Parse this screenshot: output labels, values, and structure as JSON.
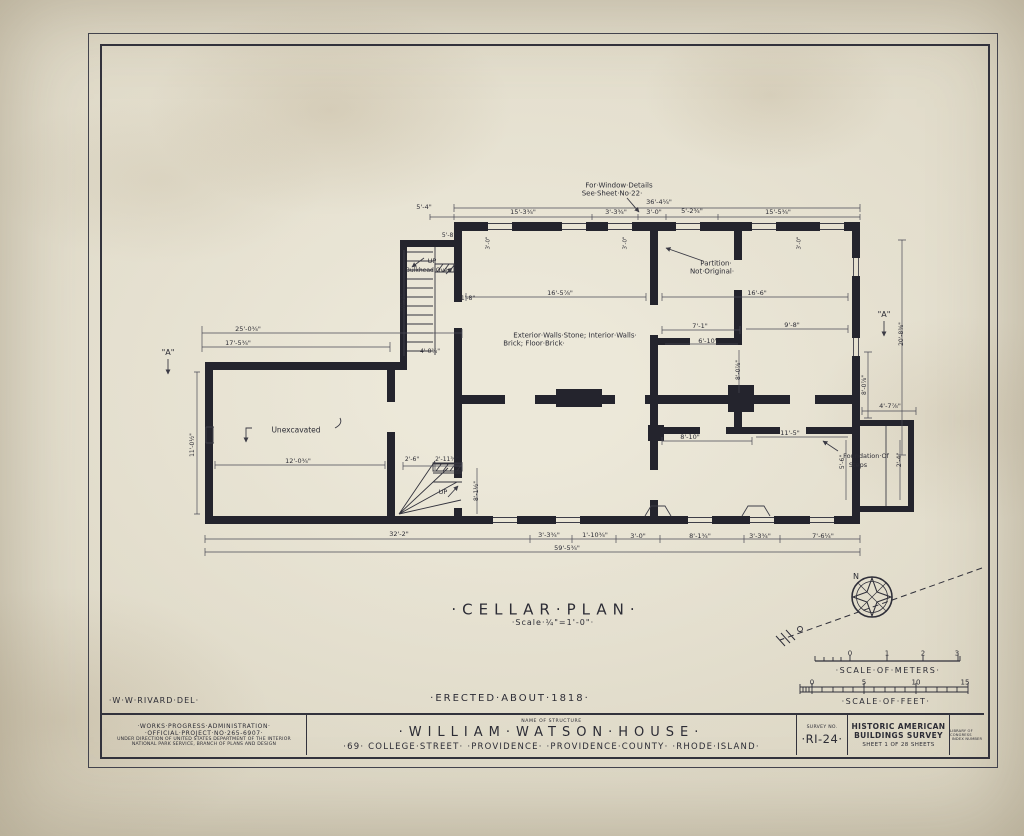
{
  "colors": {
    "ink": "#2c2c35",
    "wall_ink": "#24242d",
    "paper": "#ded8c6"
  },
  "title_block": {
    "wpa_line1": "·WORKS·PROGRESS·ADMINISTRATION·",
    "wpa_line2": "·OFFICIAL·PROJECT·NO·265-6907·",
    "wpa_line3": "UNDER DIRECTION OF UNITED STATES DEPARTMENT OF THE INTERIOR",
    "wpa_line4": "NATIONAL PARK SERVICE, BRANCH OF PLANS AND DESIGN",
    "name_of_structure_label": "NAME OF STRUCTURE",
    "structure_name": "·WILLIAM·WATSON·HOUSE·",
    "address": "·69· COLLEGE·STREET· ·PROVIDENCE· ·PROVIDENCE·COUNTY· ·RHODE·ISLAND·",
    "survey_no_label": "SURVEY NO.",
    "survey_no": "·RI-24·",
    "habs_line1": "HISTORIC AMERICAN",
    "habs_line2": "BUILDINGS SURVEY",
    "sheet_line": "SHEET 1 OF 28 SHEETS",
    "loc_line1": "LIBRARY OF CONGRESS",
    "loc_line2": "INDEX NUMBER"
  },
  "annotations": [
    {
      "name": "drawing-title",
      "t": "·CELLAR·PLAN·",
      "x": 546,
      "y": 610,
      "s": 15,
      "ls": 6
    },
    {
      "name": "drawing-scale",
      "t": "·Scale·¼\"=1'-0\"·",
      "x": 553,
      "y": 623,
      "s": 8,
      "ls": 1
    },
    {
      "name": "erected-note",
      "t": "·ERECTED·ABOUT·1818·",
      "x": 510,
      "y": 699,
      "s": 10,
      "ls": 2
    },
    {
      "name": "delineator",
      "t": "·W·W·RIVARD·DEL·",
      "x": 154,
      "y": 701,
      "s": 8,
      "ls": 1
    },
    {
      "name": "scale-meters-label",
      "t": "·SCALE·OF·METERS·",
      "x": 888,
      "y": 671,
      "s": 8,
      "ls": 1.5
    },
    {
      "name": "scale-feet-label",
      "t": "·SCALE·OF·FEET·",
      "x": 886,
      "y": 702,
      "s": 8,
      "ls": 1.5
    },
    {
      "name": "meters-tick-0",
      "t": "0",
      "x": 850,
      "y": 654,
      "s": 7
    },
    {
      "name": "meters-tick-1",
      "t": "1",
      "x": 887,
      "y": 654,
      "s": 7
    },
    {
      "name": "meters-tick-2",
      "t": "2",
      "x": 923,
      "y": 654,
      "s": 7
    },
    {
      "name": "meters-tick-3",
      "t": "3",
      "x": 957,
      "y": 654,
      "s": 7
    },
    {
      "name": "feet-tick-0",
      "t": "0",
      "x": 812,
      "y": 683,
      "s": 7
    },
    {
      "name": "feet-tick-5",
      "t": "5",
      "x": 864,
      "y": 683,
      "s": 7
    },
    {
      "name": "feet-tick-10",
      "t": "10",
      "x": 916,
      "y": 683,
      "s": 7
    },
    {
      "name": "feet-tick-15",
      "t": "15",
      "x": 965,
      "y": 683,
      "s": 7
    },
    {
      "name": "compass-north-label",
      "t": "N",
      "x": 856,
      "y": 577,
      "s": 8
    },
    {
      "name": "window-note-line1",
      "t": "For·Window·Details",
      "x": 619,
      "y": 186,
      "s": 7
    },
    {
      "name": "window-note-line2",
      "t": "See·Sheet·No·22·",
      "x": 612,
      "y": 194,
      "s": 7
    },
    {
      "name": "partition-note-line1",
      "t": "Partition·",
      "x": 716,
      "y": 264,
      "s": 7
    },
    {
      "name": "partition-note-line2",
      "t": "Not·Original·",
      "x": 712,
      "y": 272,
      "s": 7
    },
    {
      "name": "materials-note-line1",
      "t": "Exterior·Walls·Stone; Interior·Walls·",
      "x": 575,
      "y": 336,
      "s": 7
    },
    {
      "name": "materials-note-line2",
      "t": "Brick; Floor·Brick·",
      "x": 534,
      "y": 344,
      "s": 7
    },
    {
      "name": "unexcavated-label",
      "t": "Unexcavated",
      "x": 296,
      "y": 430,
      "s": 7.5
    },
    {
      "name": "foundation-note-line1",
      "t": "Foundation·Of",
      "x": 866,
      "y": 456,
      "s": 6.5
    },
    {
      "name": "foundation-note-line2",
      "t": "Steps",
      "x": 858,
      "y": 465,
      "s": 6.5
    },
    {
      "name": "up-label-bulkhead",
      "t": "UP",
      "x": 432,
      "y": 261,
      "s": 6.5
    },
    {
      "name": "bulkhead-note",
      "t": "Bulkhead·Over",
      "x": 428,
      "y": 271,
      "s": 6
    },
    {
      "name": "up-label-stair",
      "t": "UP",
      "x": 443,
      "y": 492,
      "s": 6.5
    },
    {
      "name": "section-marker-left",
      "t": "\"A\"",
      "x": 168,
      "y": 353,
      "s": 8
    },
    {
      "name": "section-marker-right",
      "t": "\"A\"",
      "x": 884,
      "y": 315,
      "s": 8
    },
    {
      "name": "dim",
      "t": "36'-4¼\"",
      "x": 659,
      "y": 202,
      "s": 6.5
    },
    {
      "name": "dim",
      "t": "5'-4\"",
      "x": 424,
      "y": 207,
      "s": 6.5
    },
    {
      "name": "dim",
      "t": "15'-3¾\"",
      "x": 523,
      "y": 212,
      "s": 6.5
    },
    {
      "name": "dim",
      "t": "3'-3¾\"",
      "x": 616,
      "y": 212,
      "s": 6.5
    },
    {
      "name": "dim",
      "t": "3'-0\"",
      "x": 654,
      "y": 212,
      "s": 6.5
    },
    {
      "name": "dim",
      "t": "5'-2¾\"",
      "x": 692,
      "y": 211,
      "s": 6.5
    },
    {
      "name": "dim",
      "t": "15'-5¾\"",
      "x": 778,
      "y": 212,
      "s": 6.5
    },
    {
      "name": "dim",
      "t": "3'-0\"",
      "x": 489,
      "y": 243,
      "s": 5.5,
      "r": -90
    },
    {
      "name": "dim",
      "t": "3'-0\"",
      "x": 626,
      "y": 243,
      "s": 5.5,
      "r": -90
    },
    {
      "name": "dim",
      "t": "3'-0\"",
      "x": 800,
      "y": 243,
      "s": 5.5,
      "r": -90
    },
    {
      "name": "dim",
      "t": "25'-0¾\"",
      "x": 248,
      "y": 329,
      "s": 6.5
    },
    {
      "name": "dim",
      "t": "17'-5¾\"",
      "x": 238,
      "y": 343,
      "s": 6.5
    },
    {
      "name": "dim",
      "t": "11'-0½\"",
      "x": 193,
      "y": 445,
      "s": 6,
      "r": -90
    },
    {
      "name": "dim",
      "t": "12'-0¾\"",
      "x": 298,
      "y": 461,
      "s": 6.5
    },
    {
      "name": "dim",
      "t": "5'-8\"",
      "x": 449,
      "y": 236,
      "s": 6
    },
    {
      "name": "dim",
      "t": "10'-2\"",
      "x": 404,
      "y": 303,
      "s": 6,
      "r": -90
    },
    {
      "name": "dim",
      "t": "1'-8\"",
      "x": 468,
      "y": 299,
      "s": 6
    },
    {
      "name": "dim",
      "t": "4'-0¾\"",
      "x": 430,
      "y": 352,
      "s": 6
    },
    {
      "name": "dim",
      "t": "2'-6\"",
      "x": 412,
      "y": 460,
      "s": 6
    },
    {
      "name": "dim",
      "t": "2'-11¾\"",
      "x": 447,
      "y": 460,
      "s": 6
    },
    {
      "name": "dim",
      "t": "8'-1½\"",
      "x": 477,
      "y": 491,
      "s": 6,
      "r": -90
    },
    {
      "name": "dim",
      "t": "16'-5⅞\"",
      "x": 560,
      "y": 293,
      "s": 6.5
    },
    {
      "name": "dim",
      "t": "16'-6\"",
      "x": 757,
      "y": 293,
      "s": 6.5
    },
    {
      "name": "dim",
      "t": "7'-1\"",
      "x": 700,
      "y": 326,
      "s": 6.5
    },
    {
      "name": "dim",
      "t": "6'-10\"",
      "x": 708,
      "y": 341,
      "s": 6.5
    },
    {
      "name": "dim",
      "t": "9'-8\"",
      "x": 792,
      "y": 325,
      "s": 6.5
    },
    {
      "name": "dim",
      "t": "8'-0⅞\"",
      "x": 739,
      "y": 370,
      "s": 6,
      "r": -90
    },
    {
      "name": "dim",
      "t": "8'-10\"",
      "x": 690,
      "y": 437,
      "s": 6.5
    },
    {
      "name": "dim",
      "t": "11'-5\"",
      "x": 790,
      "y": 433,
      "s": 6.5
    },
    {
      "name": "dim",
      "t": "8'-0⅞\"",
      "x": 865,
      "y": 385,
      "s": 6,
      "r": -90
    },
    {
      "name": "dim",
      "t": "20'-8⅜\"",
      "x": 902,
      "y": 334,
      "s": 6,
      "r": -90
    },
    {
      "name": "dim",
      "t": "4'-7⅞\"",
      "x": 890,
      "y": 406,
      "s": 6.5
    },
    {
      "name": "dim",
      "t": "5'-6\"",
      "x": 843,
      "y": 462,
      "s": 6,
      "r": -90
    },
    {
      "name": "dim",
      "t": "2'-4\"",
      "x": 900,
      "y": 460,
      "s": 6,
      "r": -90
    },
    {
      "name": "dim",
      "t": "32'-2\"",
      "x": 399,
      "y": 534,
      "s": 6.5
    },
    {
      "name": "dim",
      "t": "3'-3¾\"",
      "x": 549,
      "y": 535,
      "s": 6.5
    },
    {
      "name": "dim",
      "t": "1'-10¾\"",
      "x": 595,
      "y": 535,
      "s": 6.5
    },
    {
      "name": "dim",
      "t": "3'-0\"",
      "x": 638,
      "y": 536,
      "s": 6.5
    },
    {
      "name": "dim",
      "t": "8'-1¾\"",
      "x": 700,
      "y": 536,
      "s": 6.5
    },
    {
      "name": "dim",
      "t": "3'-3¾\"",
      "x": 760,
      "y": 536,
      "s": 6.5
    },
    {
      "name": "dim",
      "t": "7'-6¼\"",
      "x": 823,
      "y": 536,
      "s": 6.5
    },
    {
      "name": "dim",
      "t": "59'-5¾\"",
      "x": 567,
      "y": 548,
      "s": 6.5
    }
  ]
}
